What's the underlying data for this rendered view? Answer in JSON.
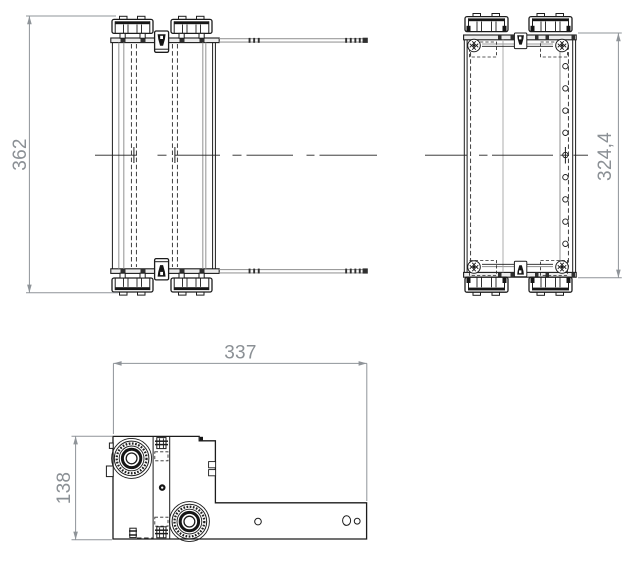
{
  "drawing": {
    "background": "#ffffff",
    "line_color": "#1c1c1c",
    "secondary_line_color": "#9b9b9b",
    "dimension_color": "#8b9095",
    "views": {
      "front": "front-view",
      "side": "side-view",
      "plan": "plan-view"
    },
    "dimensions": {
      "front_height": "362",
      "side_height": "324,4",
      "plan_width": "337",
      "plan_depth": "138"
    }
  }
}
